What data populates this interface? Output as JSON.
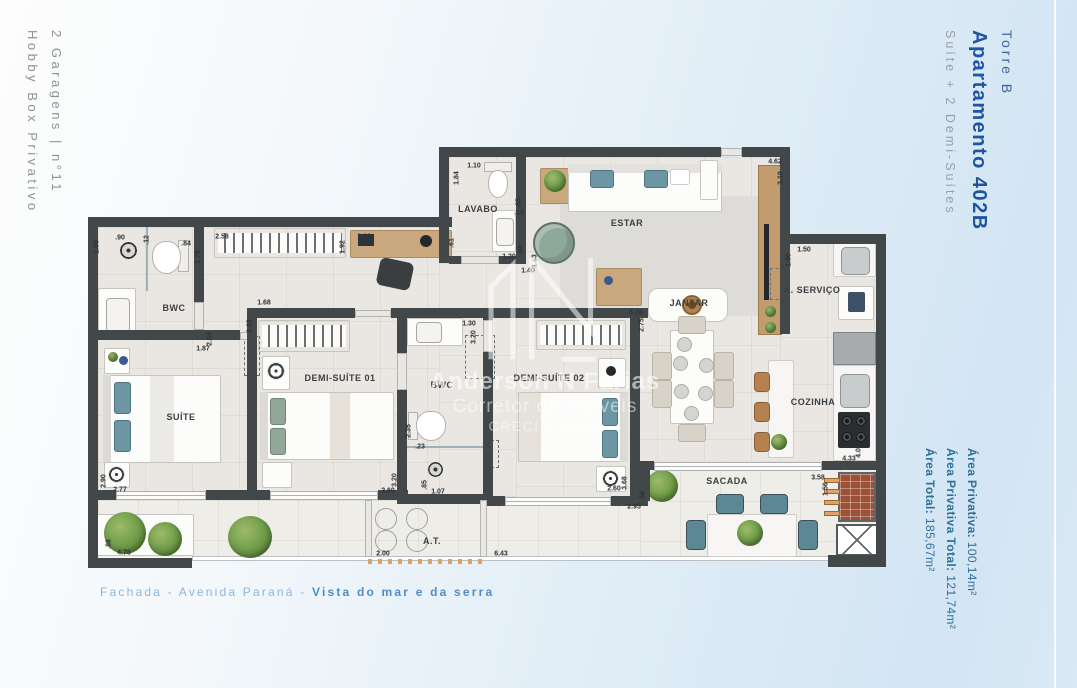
{
  "side_left": {
    "line1": "2 Garagens | n°11",
    "line2": "Hobby Box Privativo"
  },
  "side_right": {
    "tower": "Torre B",
    "apartment": "Apartamento 402B",
    "subtitle": "Suíte + 2 Demi-Suítes"
  },
  "areas": [
    {
      "label": "Área Privativa:",
      "value": " 100,14m²"
    },
    {
      "label": "Área Privativa Total:",
      "value": " 121,74m²"
    },
    {
      "label": "Área Total:",
      "value": " 185,67m²"
    }
  ],
  "caption": {
    "regular": "Fachada - Avenida Paraná - ",
    "bold": "Vista do mar e da serra"
  },
  "watermark": {
    "name": "Anderson N Farias",
    "role": "Corretor de imóveis",
    "creci": "CRECI F46363"
  },
  "colors": {
    "wall": "#42474a",
    "accent_blue": "#1d55a0",
    "area_text": "#2f7299",
    "caption_blue": "#4e8dc9"
  },
  "floorplan": {
    "rooms": [
      {
        "label": "BWC",
        "x": 174,
        "y": 308
      },
      {
        "label": "LAVABO",
        "x": 478,
        "y": 209
      },
      {
        "label": "ESTAR",
        "x": 627,
        "y": 223
      },
      {
        "label": "JANTAR",
        "x": 689,
        "y": 303
      },
      {
        "label": "A. SERVIÇO",
        "x": 812,
        "y": 290
      },
      {
        "label": "COZINHA",
        "x": 813,
        "y": 402
      },
      {
        "label": "SUÍTE",
        "x": 181,
        "y": 417
      },
      {
        "label": "DEMI-SUÍTE 01",
        "x": 340,
        "y": 378
      },
      {
        "label": "BWC",
        "x": 442,
        "y": 385
      },
      {
        "label": "DEMI-SUÍTE 02",
        "x": 549,
        "y": 378
      },
      {
        "label": "SACADA",
        "x": 727,
        "y": 481
      },
      {
        "label": "A.T.",
        "x": 432,
        "y": 541
      }
    ],
    "dimensions": [
      {
        "t": "1.90",
        "x": 97,
        "y": 247,
        "v": true
      },
      {
        "t": ".90",
        "x": 120,
        "y": 238
      },
      {
        "t": ".12",
        "x": 147,
        "y": 240,
        "v": true
      },
      {
        "t": ".84",
        "x": 186,
        "y": 244
      },
      {
        "t": "1.78",
        "x": 198,
        "y": 257,
        "v": true
      },
      {
        "t": "2.58",
        "x": 222,
        "y": 237
      },
      {
        "t": "1.92",
        "x": 343,
        "y": 247,
        "v": true
      },
      {
        "t": "1.88",
        "x": 364,
        "y": 237
      },
      {
        "t": ".61",
        "x": 452,
        "y": 243,
        "v": true
      },
      {
        "t": "1.10",
        "x": 474,
        "y": 166
      },
      {
        "t": "1.84",
        "x": 457,
        "y": 178,
        "v": true
      },
      {
        "t": ".85",
        "x": 519,
        "y": 203,
        "v": true
      },
      {
        "t": ".10",
        "x": 519,
        "y": 213
      },
      {
        "t": ".98",
        "x": 521,
        "y": 250,
        "v": true
      },
      {
        "t": "1.20",
        "x": 509,
        "y": 257
      },
      {
        "t": "1.93",
        "x": 535,
        "y": 261,
        "v": true
      },
      {
        "t": "1.40",
        "x": 528,
        "y": 271
      },
      {
        "t": "4.62",
        "x": 775,
        "y": 162
      },
      {
        "t": "3.19",
        "x": 781,
        "y": 178,
        "v": true
      },
      {
        "t": "1.50",
        "x": 804,
        "y": 250
      },
      {
        "t": "1.60",
        "x": 789,
        "y": 260,
        "v": true
      },
      {
        "t": "1.68",
        "x": 264,
        "y": 303
      },
      {
        "t": "3.33",
        "x": 250,
        "y": 326,
        "v": true
      },
      {
        "t": "2.04",
        "x": 210,
        "y": 339,
        "v": true
      },
      {
        "t": "1.87",
        "x": 203,
        "y": 349
      },
      {
        "t": "1.30",
        "x": 469,
        "y": 324
      },
      {
        "t": "3.20",
        "x": 474,
        "y": 337,
        "v": true
      },
      {
        "t": "5.26",
        "x": 636,
        "y": 313
      },
      {
        "t": "2.75",
        "x": 642,
        "y": 325,
        "v": true
      },
      {
        "t": "2.35",
        "x": 409,
        "y": 431,
        "v": true
      },
      {
        "t": ".23",
        "x": 420,
        "y": 447
      },
      {
        "t": "3.20",
        "x": 395,
        "y": 480,
        "v": true
      },
      {
        "t": "2.60",
        "x": 388,
        "y": 491
      },
      {
        "t": ".85",
        "x": 425,
        "y": 485,
        "v": true
      },
      {
        "t": "1.07",
        "x": 438,
        "y": 492
      },
      {
        "t": "2.90",
        "x": 104,
        "y": 481,
        "v": true
      },
      {
        "t": "2.77",
        "x": 120,
        "y": 490
      },
      {
        "t": ".88",
        "x": 109,
        "y": 544,
        "v": true
      },
      {
        "t": "4.78",
        "x": 124,
        "y": 553
      },
      {
        "t": "2.00",
        "x": 383,
        "y": 554
      },
      {
        "t": "6.43",
        "x": 501,
        "y": 554
      },
      {
        "t": "2.60",
        "x": 614,
        "y": 489
      },
      {
        "t": "3.68",
        "x": 625,
        "y": 483,
        "v": true
      },
      {
        "t": "2.95",
        "x": 634,
        "y": 507
      },
      {
        "t": ".58",
        "x": 643,
        "y": 496,
        "v": true
      },
      {
        "t": "3.58",
        "x": 818,
        "y": 478
      },
      {
        "t": "1.56",
        "x": 826,
        "y": 489,
        "v": true
      },
      {
        "t": "4.33",
        "x": 849,
        "y": 459
      },
      {
        "t": "4.04",
        "x": 859,
        "y": 451,
        "v": true
      }
    ]
  }
}
